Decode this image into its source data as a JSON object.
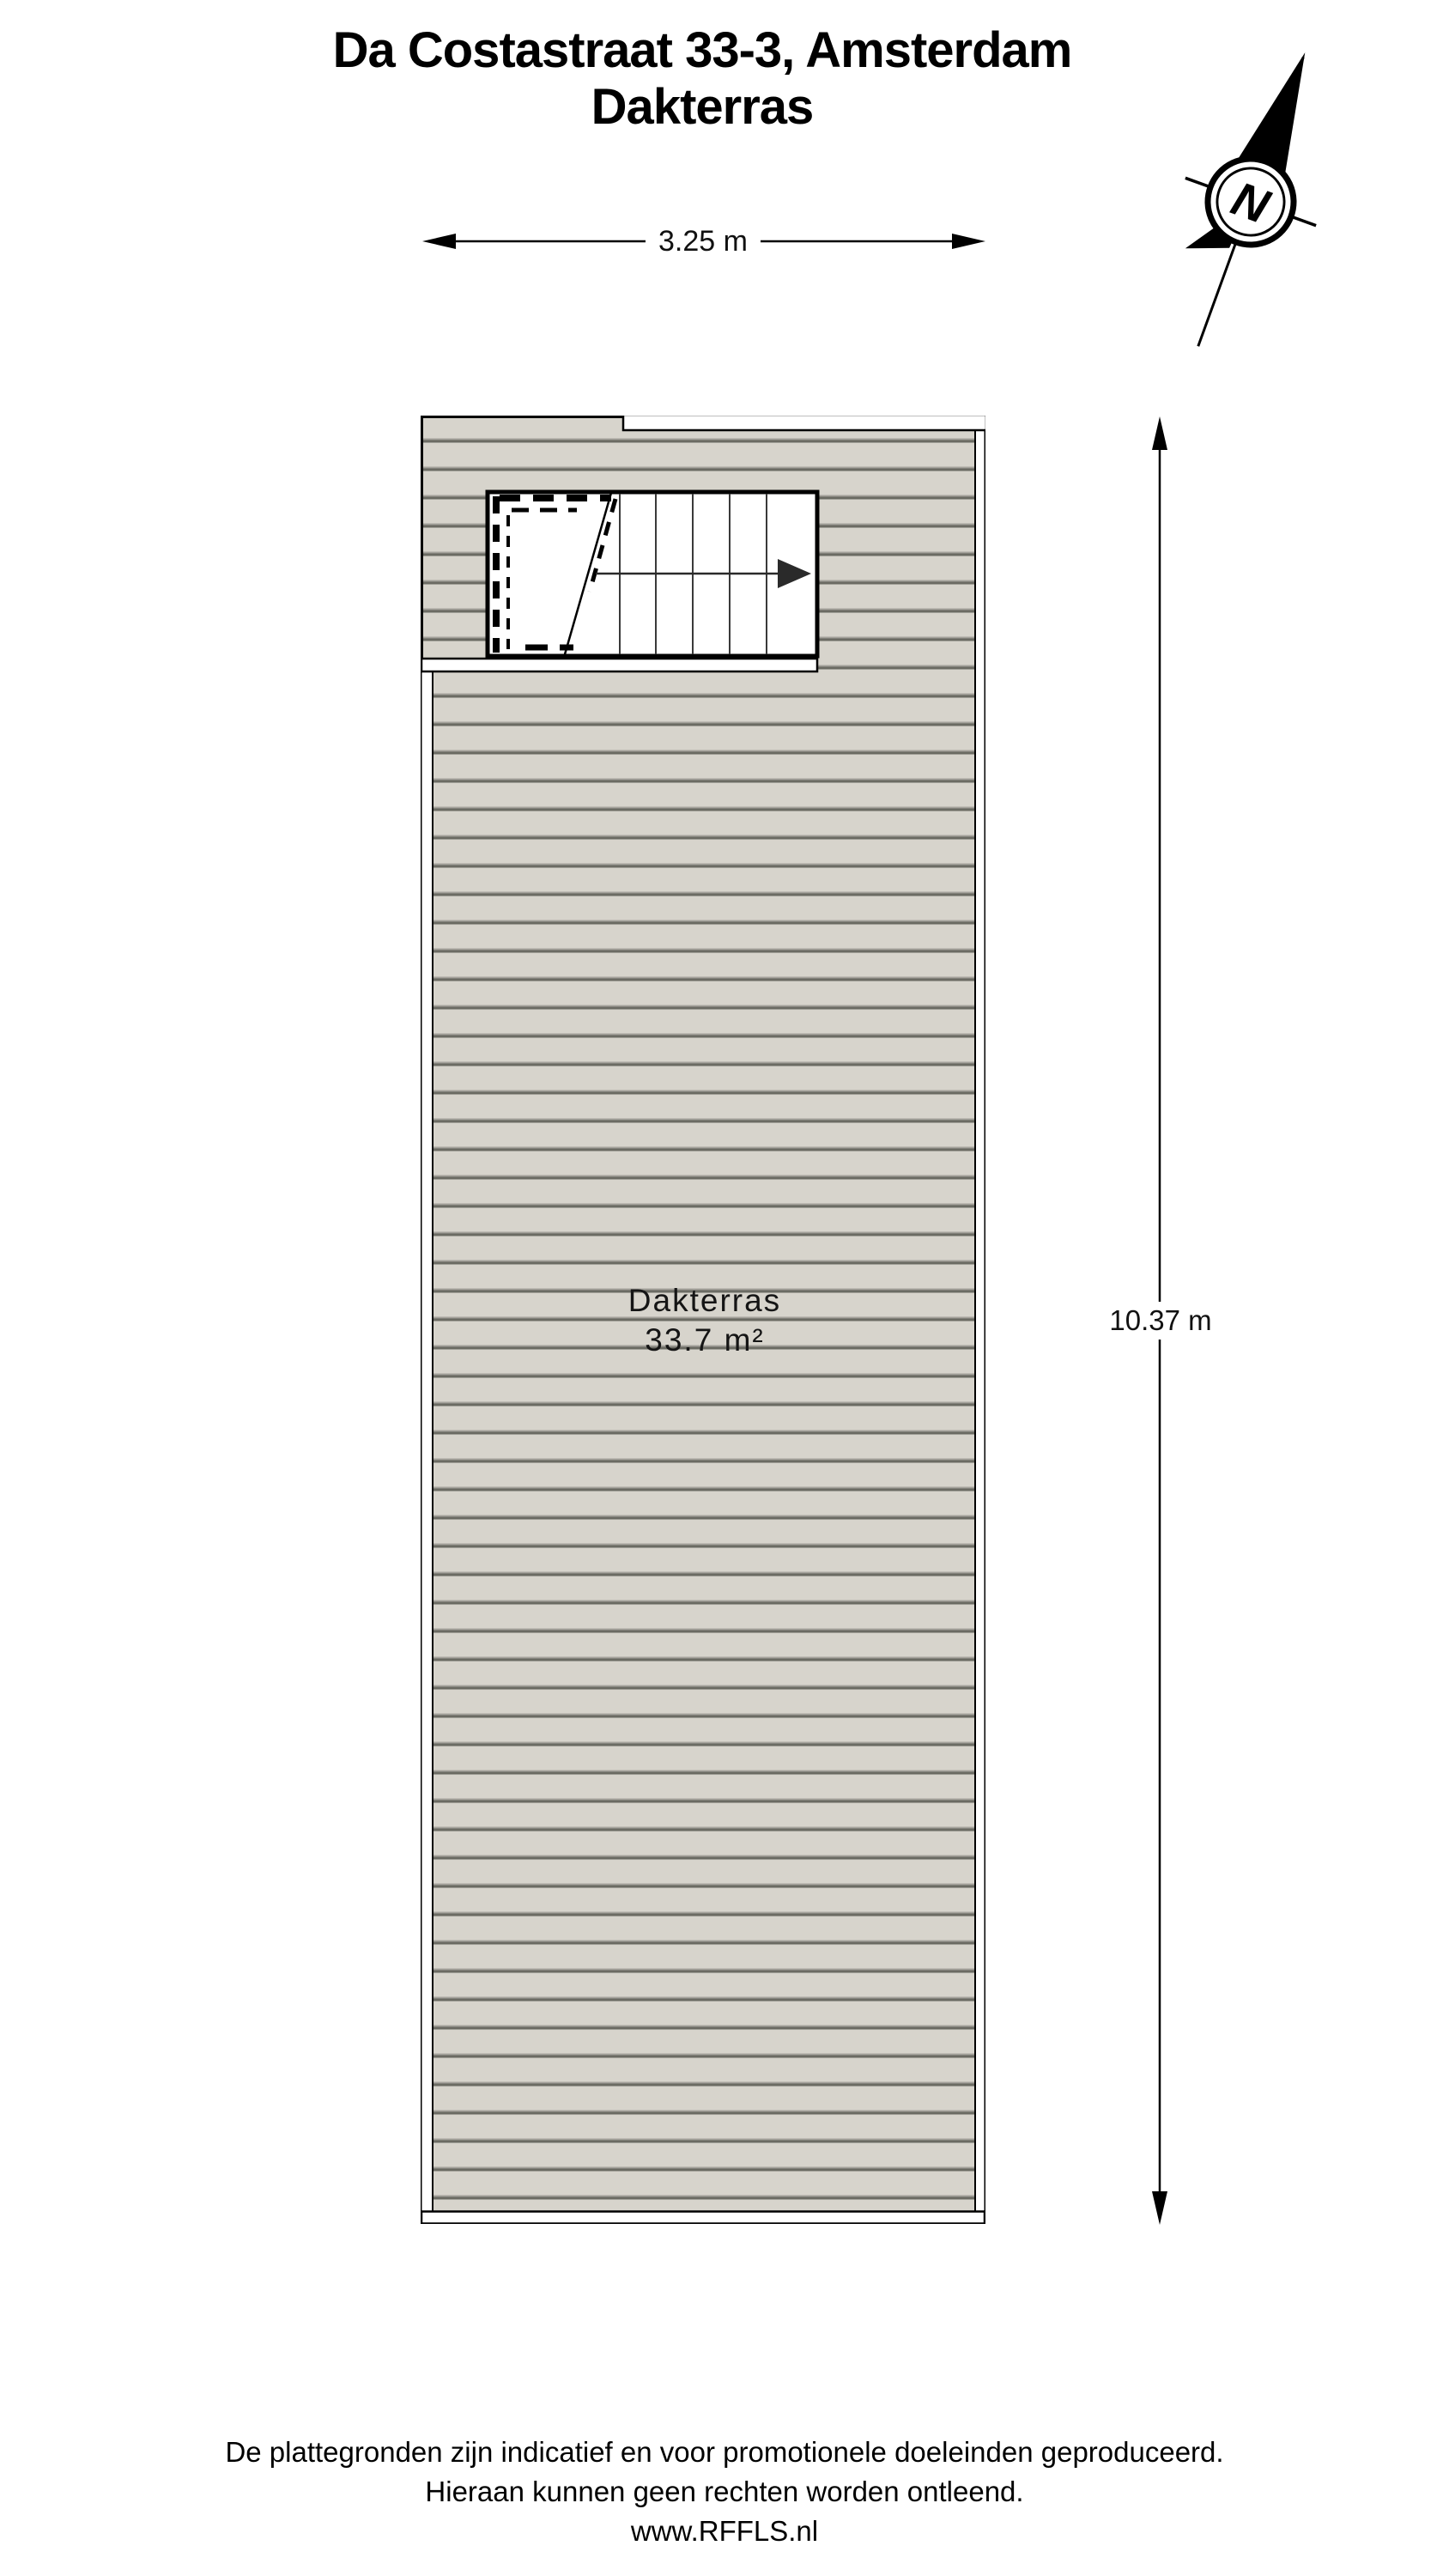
{
  "title": {
    "line1": "Da Costastraat 33-3, Amsterdam",
    "line2": "Dakterras"
  },
  "compass": {
    "label": "N"
  },
  "dimensions": {
    "width_label": "3.25 m",
    "height_label": "10.37 m"
  },
  "room": {
    "name": "Dakterras",
    "area": "33.7 m²"
  },
  "footer": {
    "line1": "De plattegronden zijn indicatief en voor promotionele doeleinden geproduceerd.",
    "line2": "Hieraan kunnen geen rechten worden ontleend.",
    "line3": "www.RFFLS.nl"
  },
  "colors": {
    "deck_fill": "#d7d4cc",
    "groove_light": "#a3a19a",
    "groove_dark": "#6b6b63",
    "ink": "#000000",
    "arrow_ink": "#2a2a2a"
  }
}
